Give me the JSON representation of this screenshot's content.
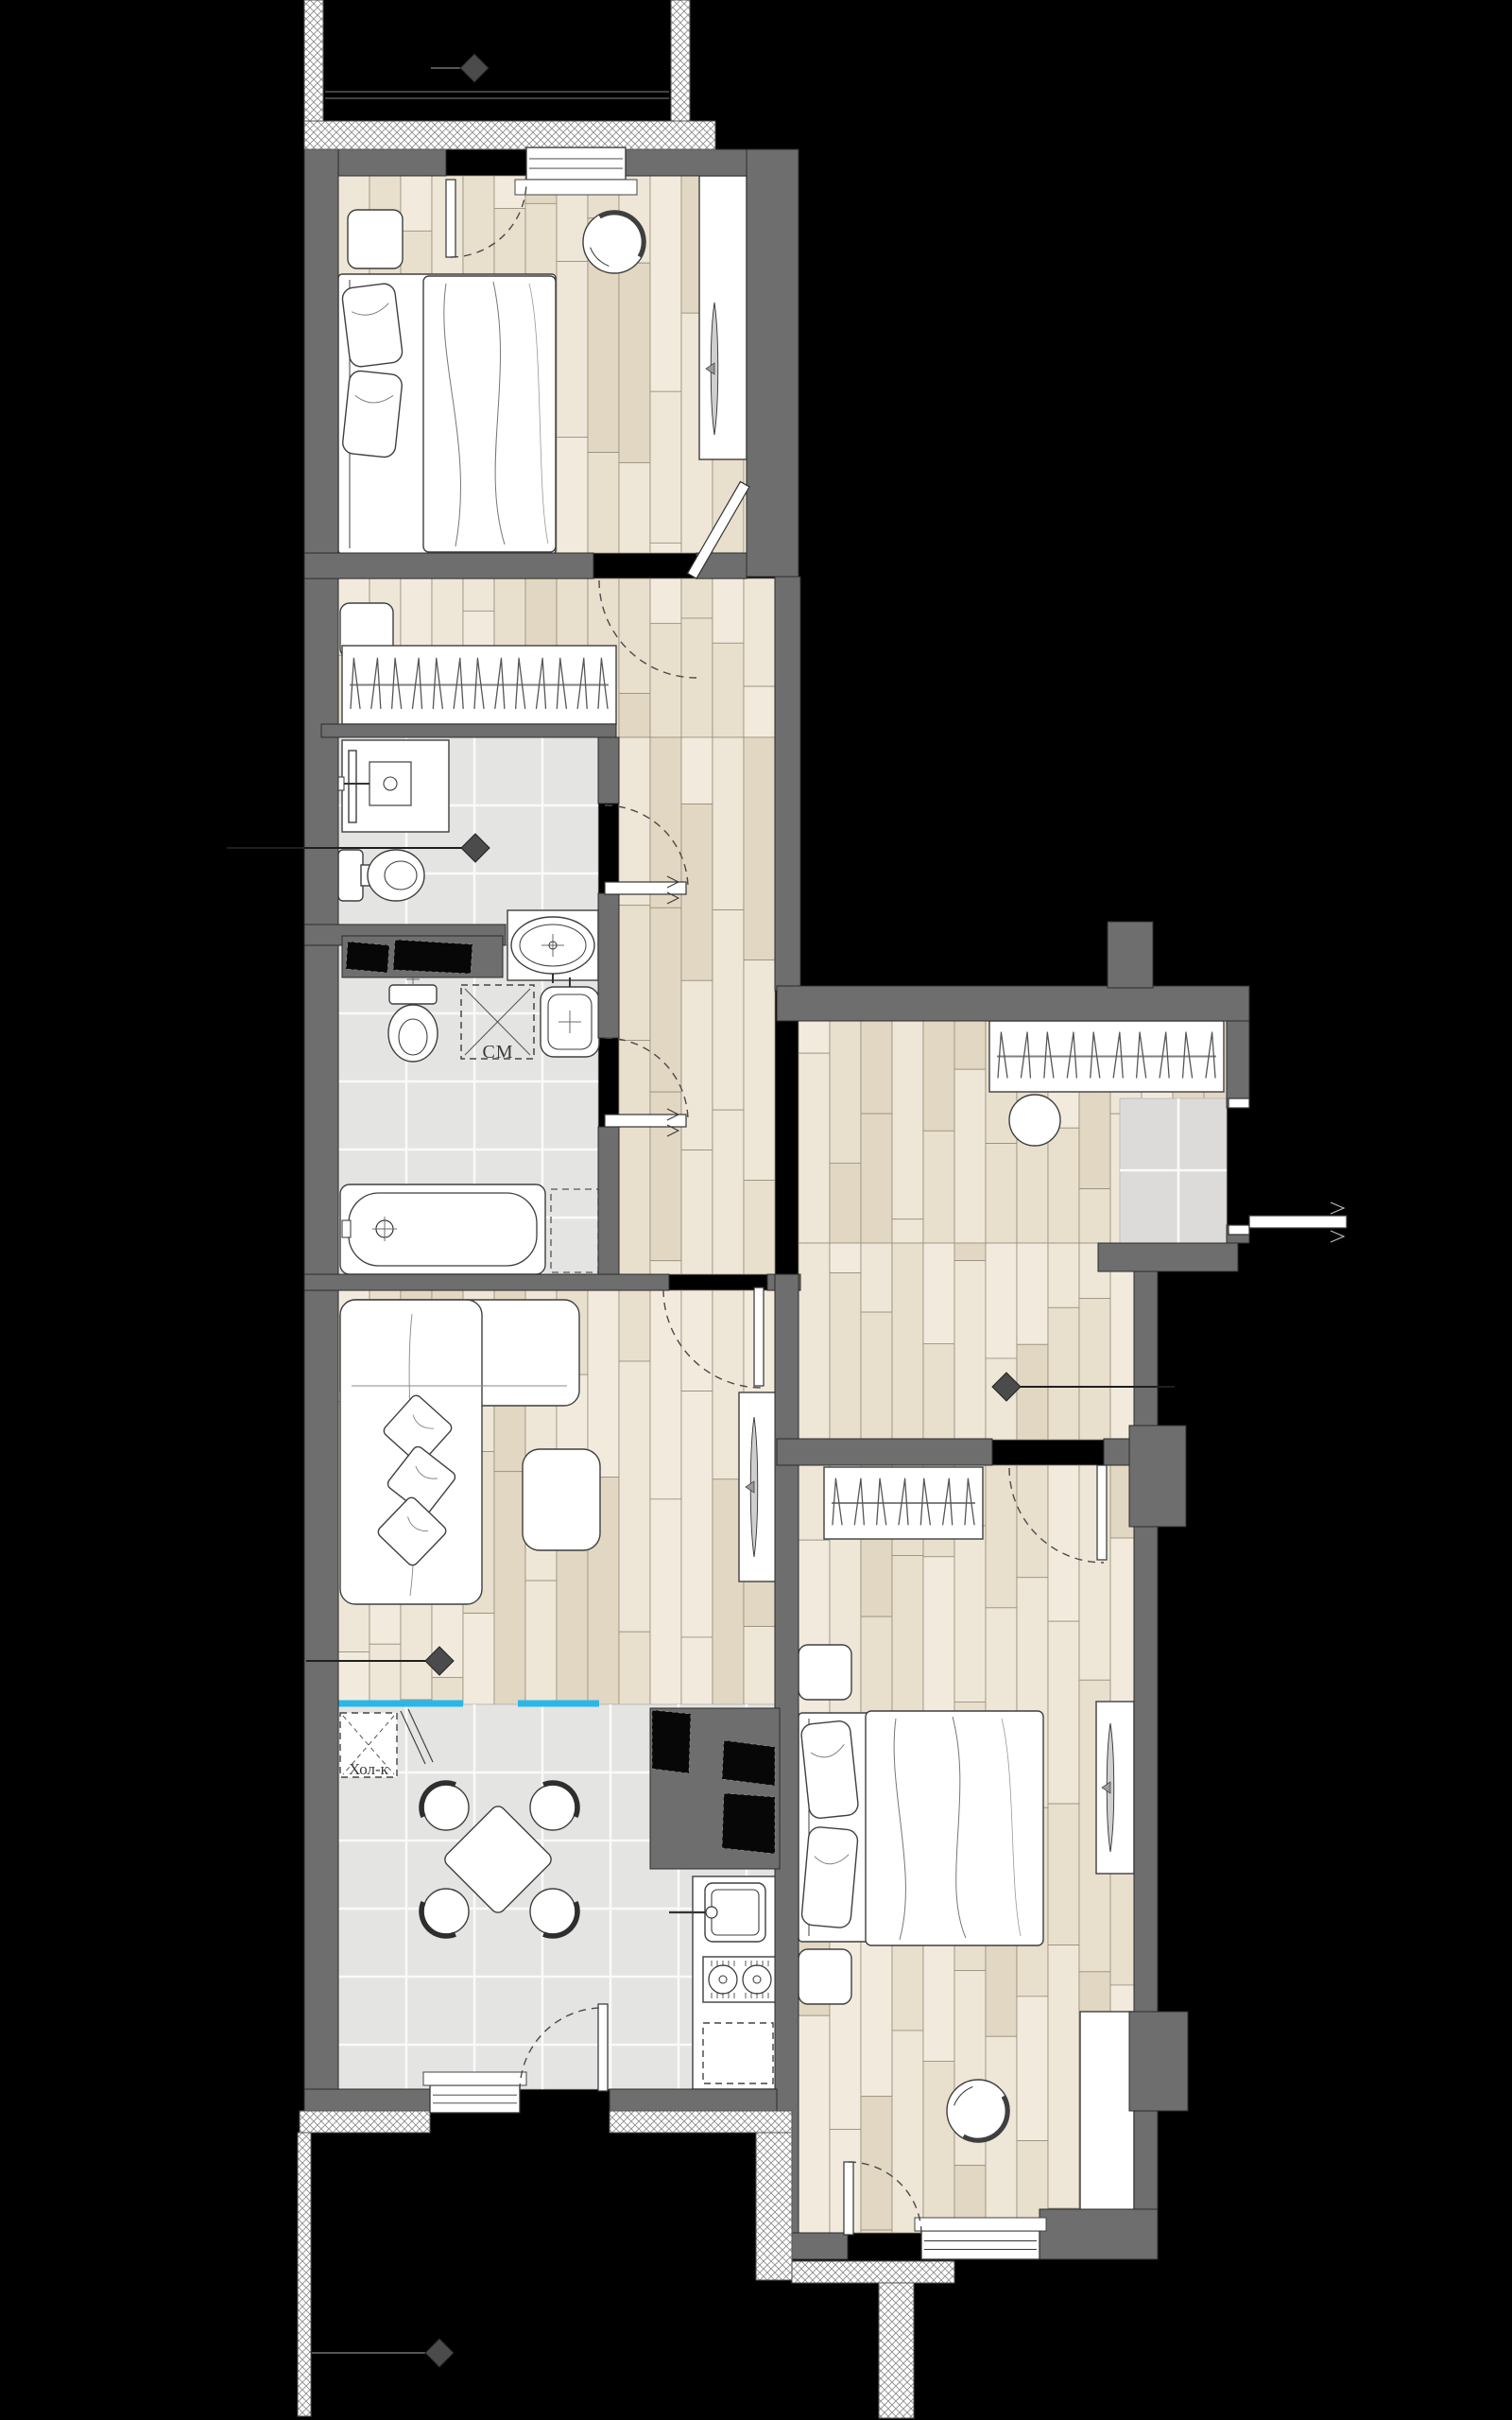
{
  "plan": {
    "labels": {
      "washing_machine": "СМ",
      "fridge": "Хол-к"
    },
    "colors": {
      "background": "#000000",
      "wall": "#6e6e6e",
      "wall_stroke": "#2c2c2c",
      "wood_palette": [
        "#f2ebdd",
        "#e9dfcd",
        "#eee6d6",
        "#e2d7c2"
      ],
      "wood_stroke": "#978e7d",
      "tile": "#e4e4e2",
      "entry_tile": "#dcdbd9",
      "grout": "#fafafa",
      "fixture_fill": "#ffffff",
      "fixture_stroke": "#3f3f3f",
      "accent_cyan": "#29b7ea",
      "diamond": "#4b4b4b",
      "hatch_line": "#8d8d8d",
      "arc": "#4a4a4a",
      "black_panel": "#070707"
    },
    "icons": {
      "diamond-marker": "rotated-square",
      "door-swing": "dashed-quarter-arc",
      "hanger": "narrow-inverted-v",
      "crosshair": "plus-in-circle",
      "tv": "thin-lens-shape"
    },
    "rooms": [
      {
        "id": "bedroom-1",
        "floor": "parquet"
      },
      {
        "id": "hall-closet",
        "floor": "parquet"
      },
      {
        "id": "shower-room",
        "floor": "tile"
      },
      {
        "id": "bathroom",
        "floor": "tile"
      },
      {
        "id": "corridor",
        "floor": "parquet"
      },
      {
        "id": "entry-hall",
        "floor": "parquet-and-tile"
      },
      {
        "id": "living-room",
        "floor": "parquet"
      },
      {
        "id": "kitchen",
        "floor": "tile"
      },
      {
        "id": "bedroom-2",
        "floor": "parquet"
      },
      {
        "id": "balconies",
        "floor": "outside"
      }
    ]
  }
}
